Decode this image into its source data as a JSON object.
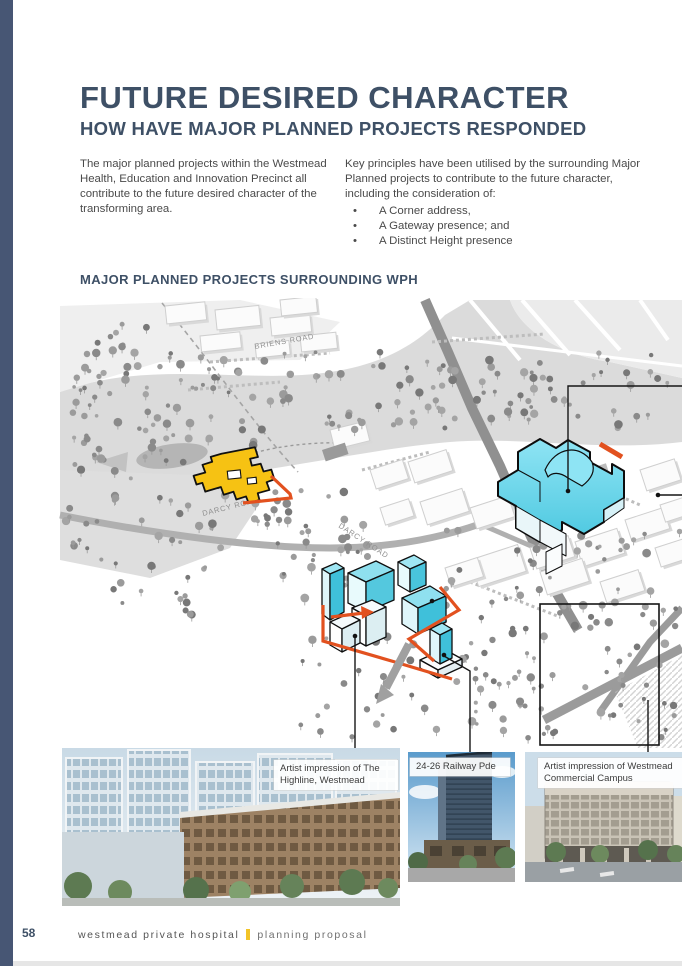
{
  "header": {
    "title": "FUTURE DESIRED CHARACTER",
    "subtitle": "HOW HAVE MAJOR PLANNED PROJECTS RESPONDED"
  },
  "intro": {
    "left_paragraph": "The major planned projects within the Westmead Health, Education and Innovation Precinct all contribute to the future desired character of the transforming area.",
    "right_paragraph": "Key principles have been utilised by the surrounding Major Planned projects to contribute to the future character, including the consideration of:",
    "bullets": [
      "A Corner address,",
      "A Gateway presence; and",
      "A Distinct Height presence"
    ]
  },
  "map": {
    "heading": "MAJOR PLANNED PROJECTS SURROUNDING WPH",
    "roads": {
      "briens": "BRIENS ROAD",
      "darcy": "DARCY ROAD"
    },
    "colors": {
      "highlight_yellow": "#F6C213",
      "highlight_cyan": "#5BD1E8",
      "accent_orange": "#E2511F",
      "heading_blue": "#3e5066",
      "sidebar_blue": "#475674",
      "footer_yellow": "#F2C428"
    }
  },
  "photos": [
    {
      "caption": "Artist impression of The Highline, Westmead"
    },
    {
      "caption": "24-26 Railway Pde"
    },
    {
      "caption": "Artist impression of Westmead Commercial Campus"
    }
  ],
  "footer": {
    "page_number": "58",
    "doc_title": "westmead private hospital",
    "doc_section": "planning proposal"
  }
}
